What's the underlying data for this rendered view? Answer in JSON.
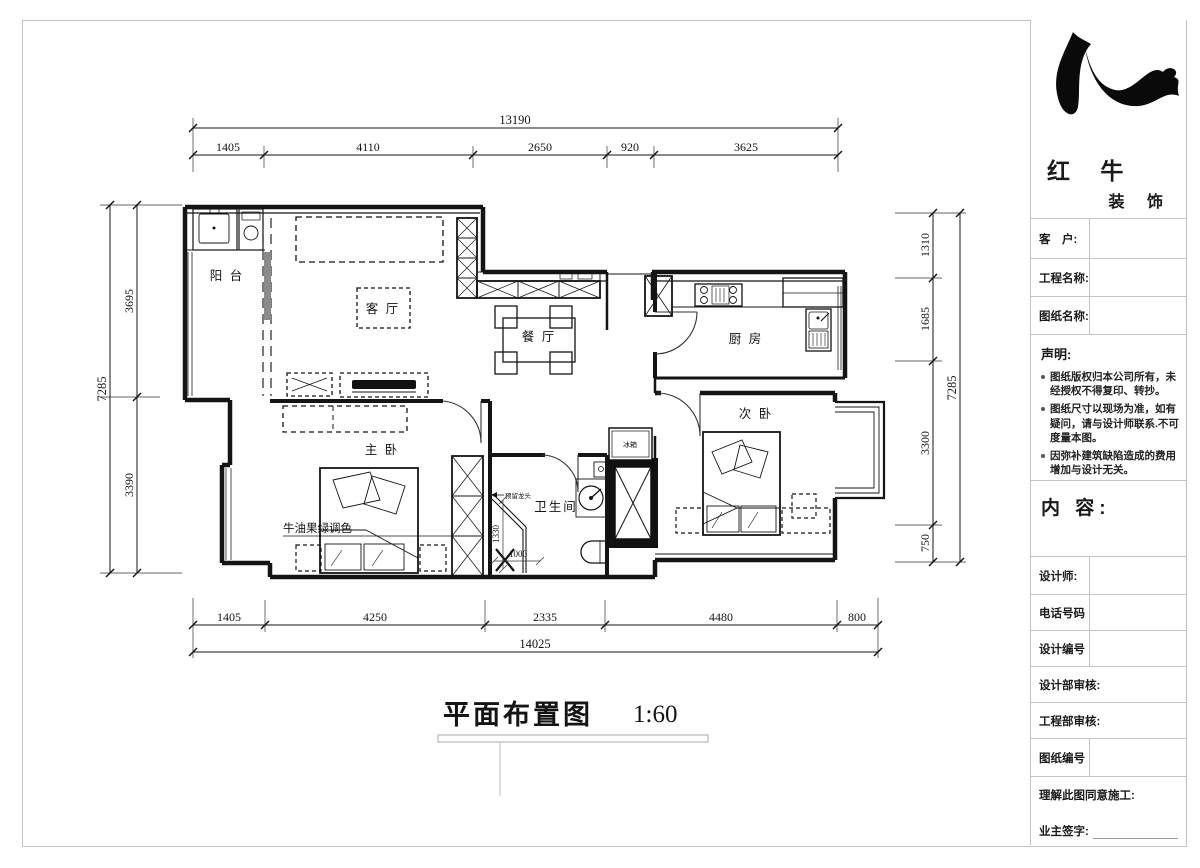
{
  "company": {
    "name": "红 牛",
    "subname": "装 饰",
    "logo": "redbull-swoosh"
  },
  "titleblock": {
    "customer_label": "客　户:",
    "project_label": "工程名称:",
    "drawing_label": "图纸名称:",
    "statement_title": "声明:",
    "statements": [
      "图纸版权归本公司所有，未经授权不得复印、转抄。",
      "图纸尺寸以现场为准，如有疑问，请与设计师联系.不可度量本图。",
      "因弥补建筑缺陷造成的费用增加与设计无关。"
    ],
    "content_label": "内 容:",
    "designer_label": "设计师:",
    "phone_label": "电话号码",
    "design_no_label": "设计编号",
    "design_review_label": "设计部审核:",
    "eng_review_label": "工程部审核:",
    "drawing_no_label": "图纸编号",
    "agree_label": "理解此图同意施工:",
    "owner_sign_label": "业主签字:"
  },
  "plan": {
    "title": "平面布置图",
    "scale": "1:60",
    "rooms": {
      "balcony": "阳 台",
      "living": "客 厅",
      "dining": "餐 厅",
      "kitchen": "厨 房",
      "master_bedroom": "主 卧",
      "secondary_bedroom": "次 卧",
      "bathroom": "卫生间",
      "fridge": "冰箱"
    },
    "annotations": {
      "color_note": "牛油果绿调色",
      "faucet_note": "预留龙头",
      "shower_depth": "1330",
      "shower_width": "1000"
    },
    "dimensions": {
      "top": {
        "total": "13190",
        "segments": [
          "1405",
          "4110",
          "2650",
          "920",
          "3625"
        ]
      },
      "bottom": {
        "total": "14025",
        "segments": [
          "1405",
          "4250",
          "2335",
          "4480",
          "800"
        ]
      },
      "left": {
        "total": "7285",
        "segments": [
          "3695",
          "3390"
        ]
      },
      "right": {
        "total": "7285",
        "segments": [
          "1310",
          "1685",
          "3300",
          "750"
        ]
      }
    }
  }
}
